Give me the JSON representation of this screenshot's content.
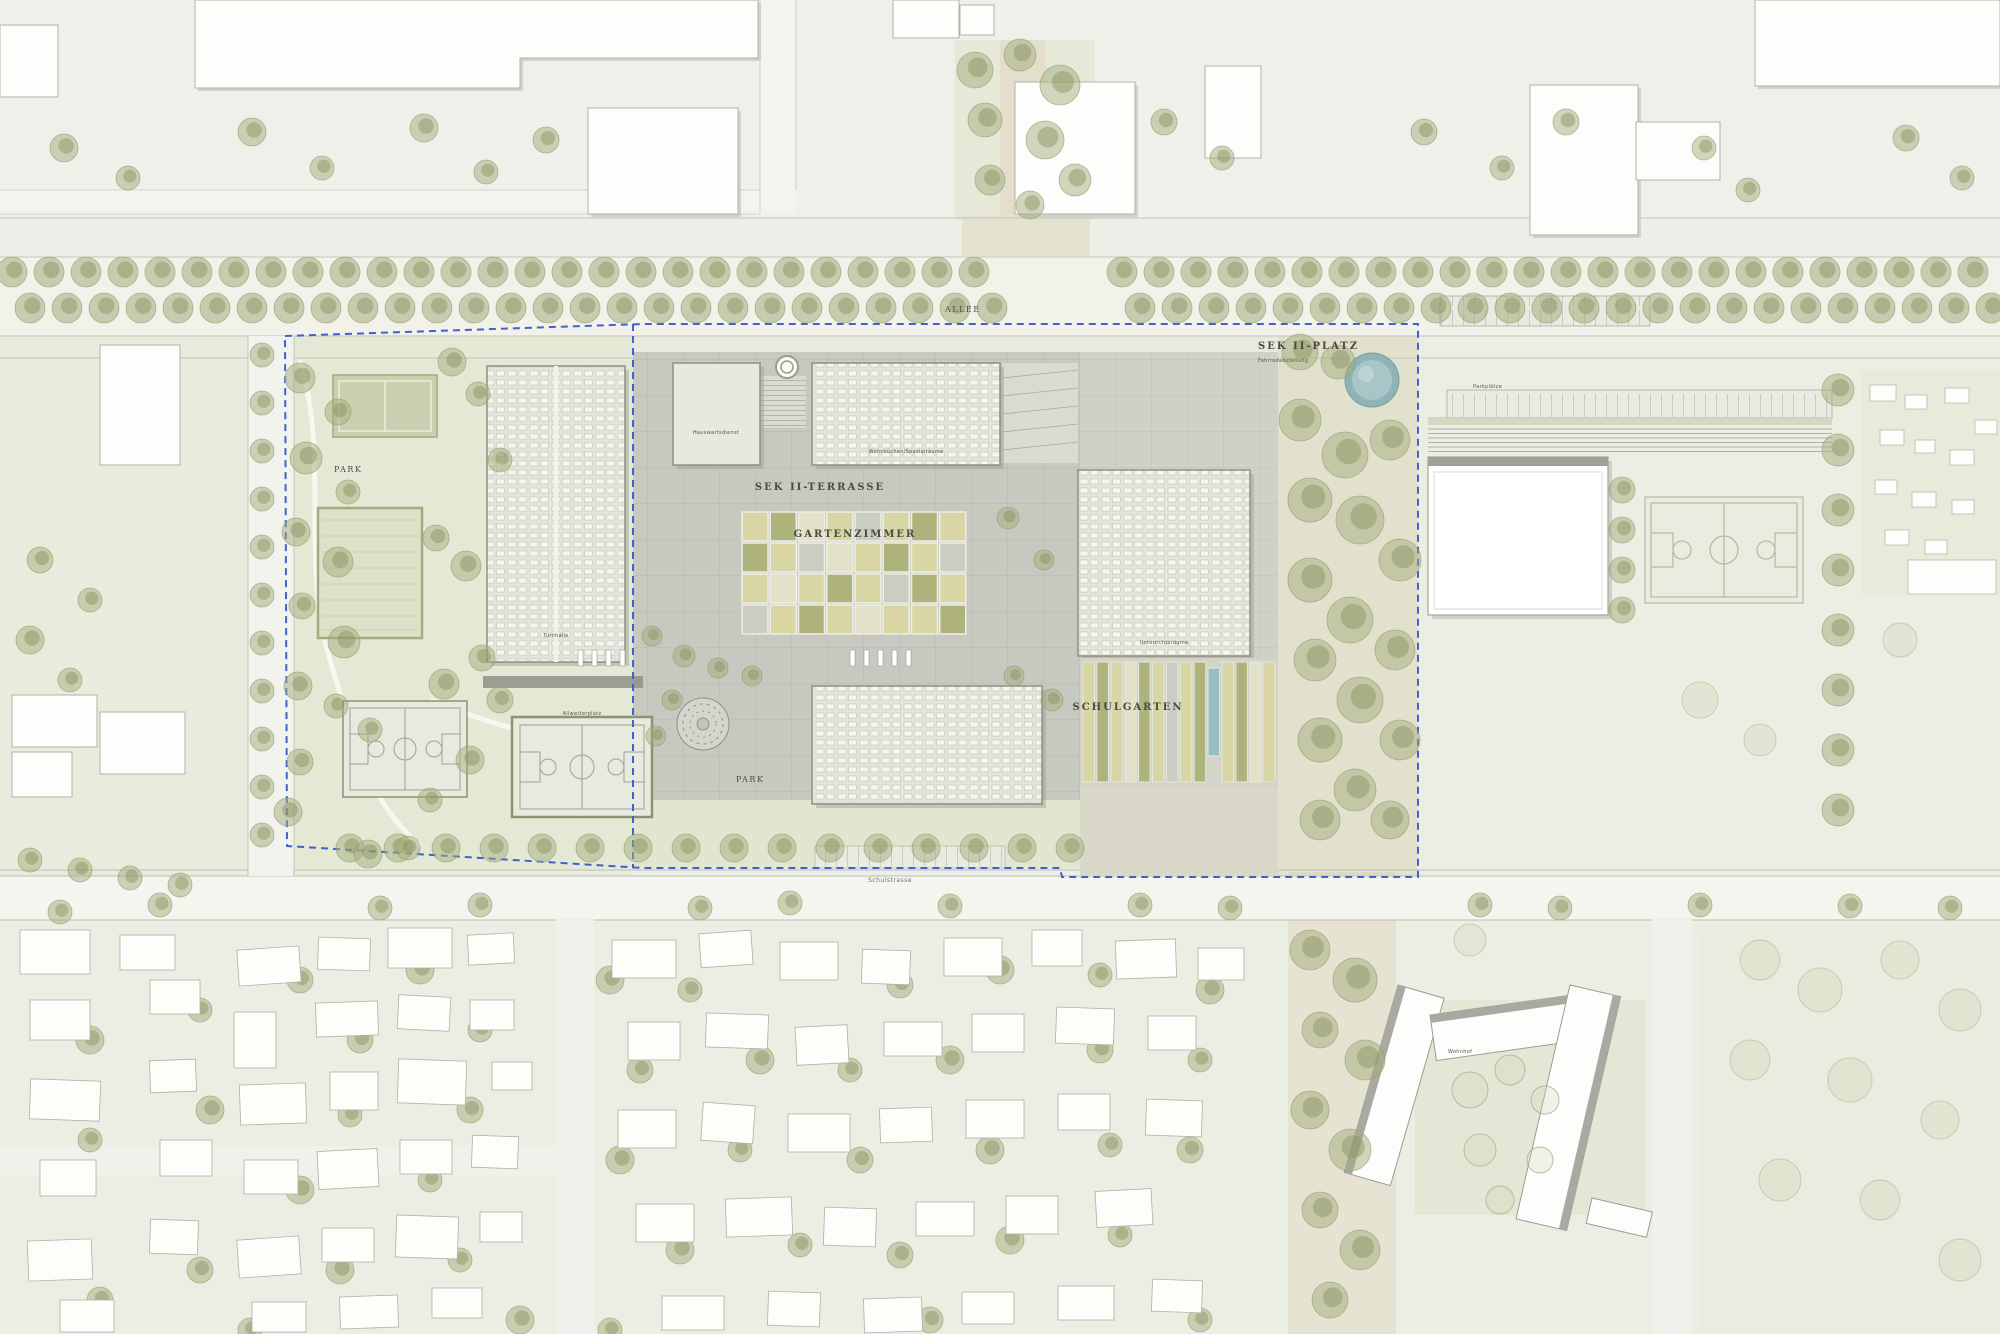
{
  "labels": {
    "allee": "ALLEE",
    "park_west": "PARK",
    "park_south": "PARK",
    "sek2_terrasse": "SEK II-TERRASSE",
    "gartenzimmer": "GARTENZIMMER",
    "schulgarten": "SCHULGARTEN",
    "sek2_platz": "SEK II-PLATZ",
    "sek2_platz_sub": "Fahrradabstellung",
    "street_south": "Schulstrasse",
    "parking_east": "Parkplätze",
    "court_allwetter": "Allwetterplatz",
    "bldg_hauswart": "Hauswartsdienst",
    "bldg_wohnkuechen": "Wohnküchen/Spezialräume",
    "bldg_turnhalle": "Turnhalle",
    "bldg_unterricht": "Unterrichtsräume",
    "wohnhof": "Wohnhof"
  },
  "colors": {
    "paper": "#edeee8",
    "paving": "#c7c9c1",
    "paving_grid": "#b7b9b1",
    "campus_building": "#e4e4db",
    "campus_building_stroke": "#8f8f85",
    "existing_fill": "#fdfdfb",
    "existing_stroke": "#b2b2aa",
    "tree_green": "#a4ad7c",
    "boundary_blue": "#3f62cc",
    "water_blue": "#8fb3b6",
    "garden_straw": "#d9d6a6",
    "garden_olive": "#aeb37c",
    "garden_blue": "#97bfc3",
    "court_green": "#c9d0b0"
  }
}
